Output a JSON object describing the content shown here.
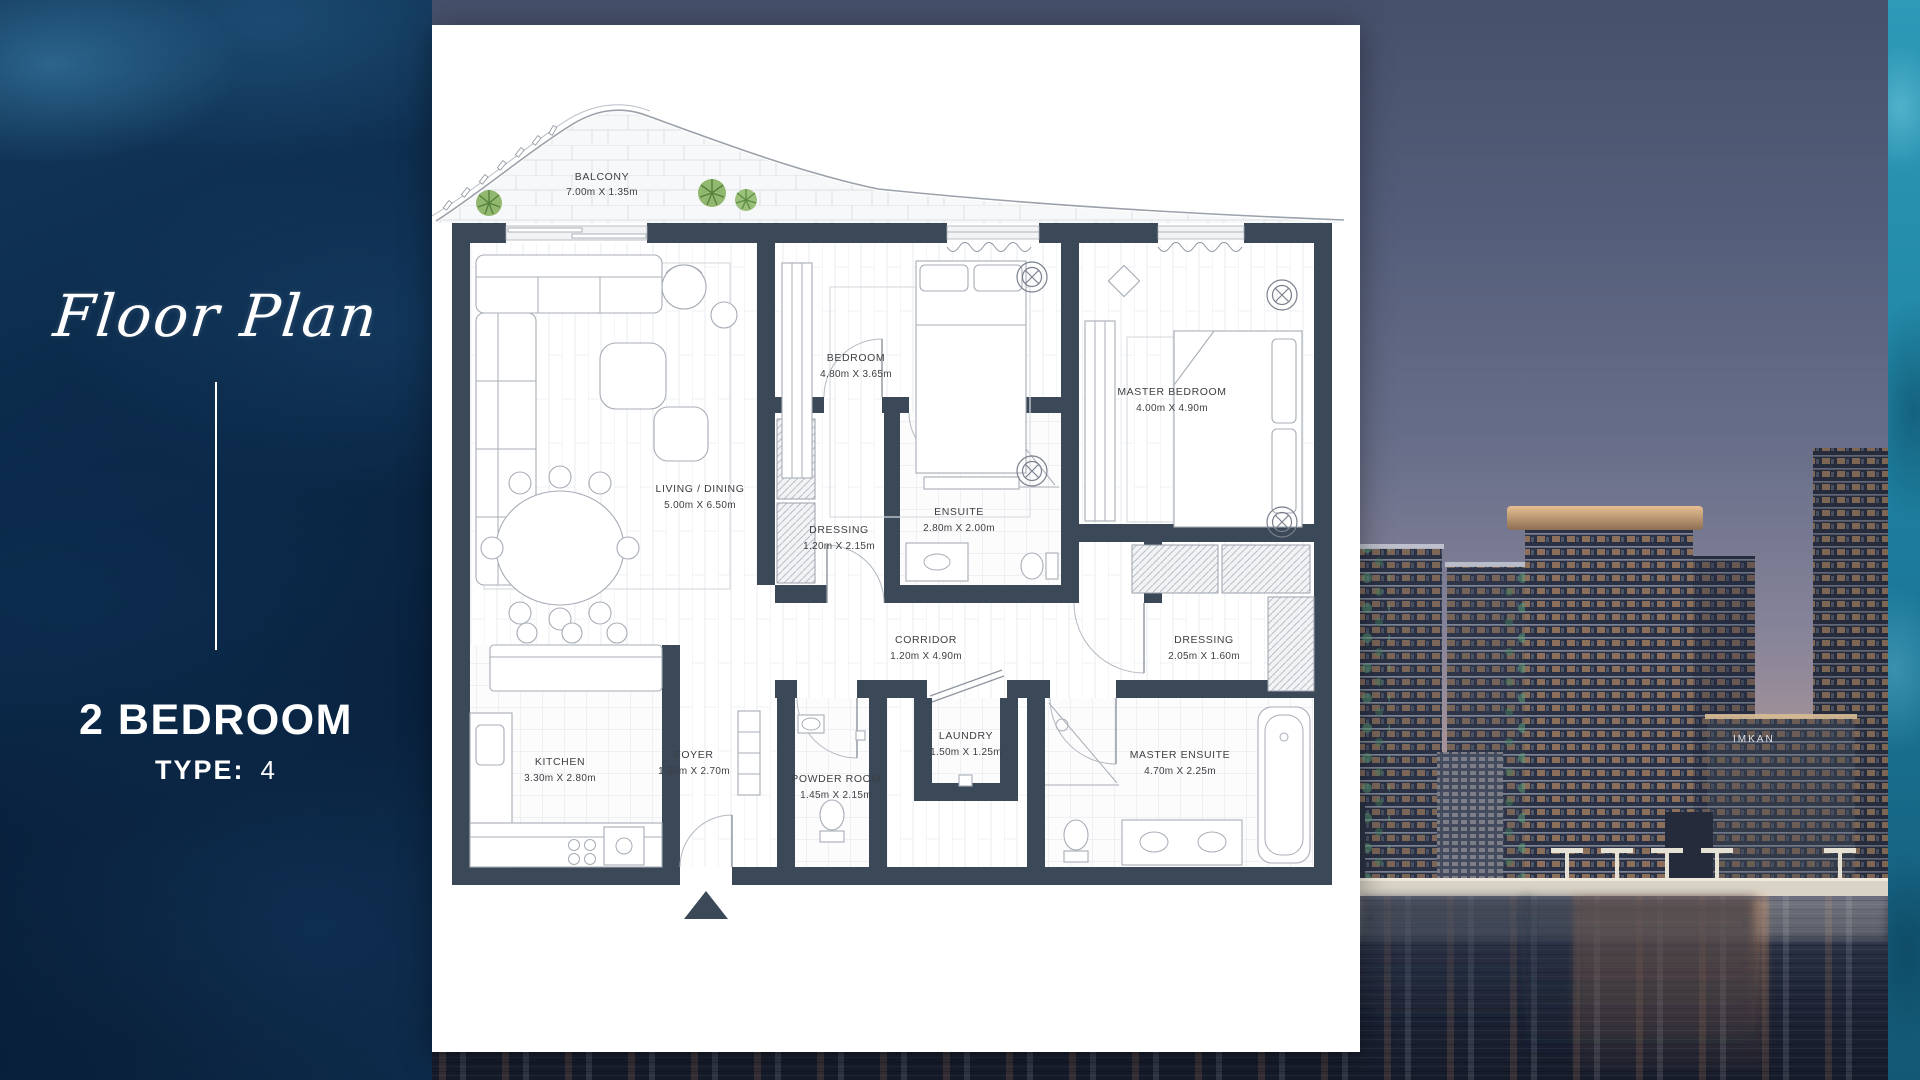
{
  "left_panel": {
    "script_title": "Floor Plan",
    "unit_name": "2 BEDROOM",
    "type_label": "TYPE:",
    "type_value": "4"
  },
  "floor_plan": {
    "rooms": [
      {
        "name": "BALCONY",
        "dims": "7.00m X 1.35m"
      },
      {
        "name": "LIVING / DINING",
        "dims": "5.00m X 6.50m"
      },
      {
        "name": "BEDROOM",
        "dims": "4.80m X 3.65m"
      },
      {
        "name": "MASTER BEDROOM",
        "dims": "4.00m X 4.90m"
      },
      {
        "name": "DRESSING",
        "dims": "1.20m X 2.15m"
      },
      {
        "name": "ENSUITE",
        "dims": "2.80m X 2.00m"
      },
      {
        "name": "CORRIDOR",
        "dims": "1.20m X 4.90m"
      },
      {
        "name": "DRESSING",
        "dims": "2.05m X 1.60m"
      },
      {
        "name": "KITCHEN",
        "dims": "3.30m X 2.80m"
      },
      {
        "name": "FOYER",
        "dims": "1.55m X 2.70m"
      },
      {
        "name": "POWDER ROOM",
        "dims": "1.45m X 2.15m"
      },
      {
        "name": "LAUNDRY",
        "dims": "1.50m X 1.25m"
      },
      {
        "name": "MASTER ENSUITE",
        "dims": "4.70m X 2.25m"
      }
    ]
  },
  "photo": {
    "building_sign": "IMKAN"
  },
  "colors": {
    "panel_navy": "#0b2949",
    "plan_wall": "#3b4858",
    "teal_strip": "#2187a6",
    "sunset_peach": "#e7bb95",
    "water_dark": "#1d2334",
    "text_white": "#ffffff"
  }
}
